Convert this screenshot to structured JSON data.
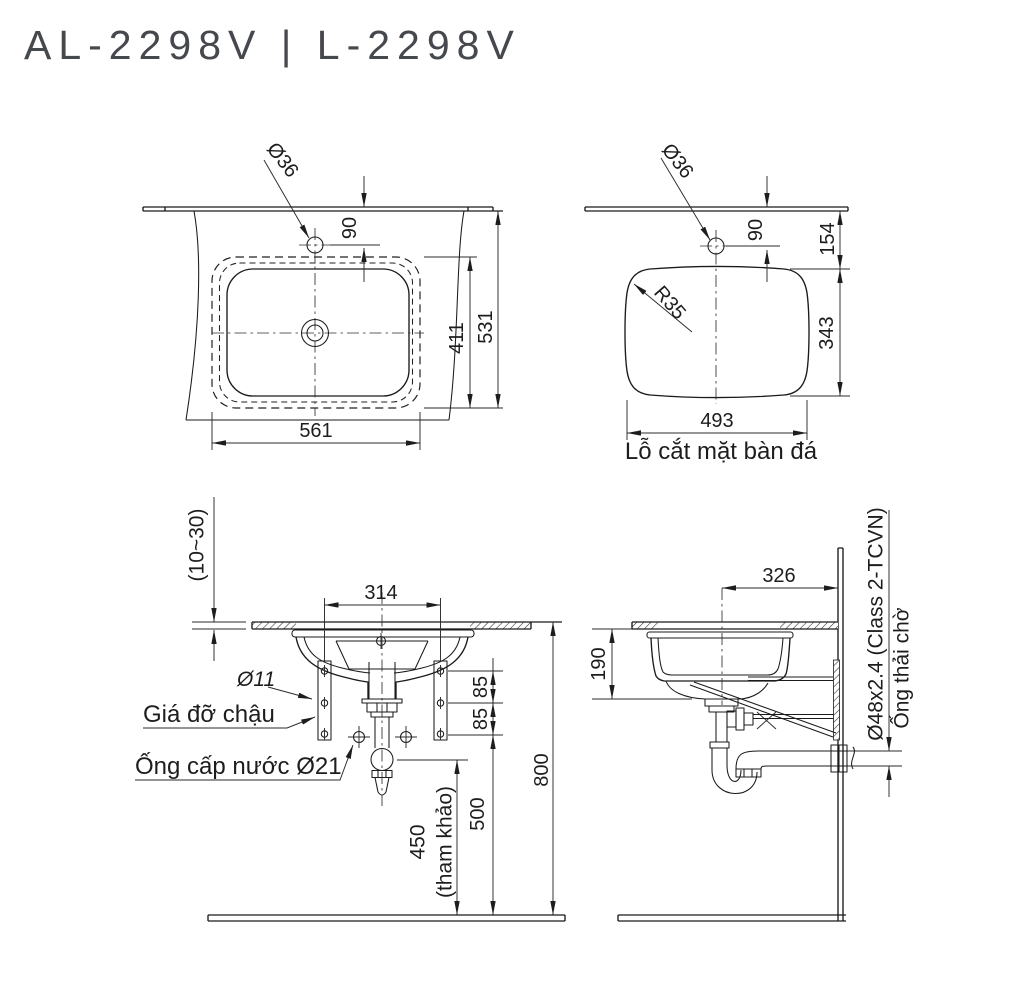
{
  "title": "AL-2298V | L-2298V",
  "plan": {
    "faucet_hole_dia": "Ø36",
    "hole_to_edge": "90",
    "bowl_depth": "411",
    "overall_depth": "531",
    "bowl_width": "561"
  },
  "cutout": {
    "faucet_hole_dia": "Ø36",
    "hole_to_edge": "90",
    "edge_to_cutout": "154",
    "corner_radius": "R35",
    "cutout_depth": "343",
    "cutout_width": "493",
    "caption": "Lỗ cắt mặt bàn đá"
  },
  "front": {
    "counter_thickness": "(10~30)",
    "bracket_spacing": "314",
    "bracket_hole_dia": "Ø11",
    "bracket_label": "Giá đỡ chậu",
    "supply_label": "Ống cấp nước Ø21",
    "hole_gap_1": "85",
    "hole_gap_2": "85",
    "drain_height": "450",
    "drain_height_note": "(tham khảo)",
    "supply_height": "500",
    "counter_height": "800"
  },
  "side": {
    "center_to_wall": "326",
    "bowl_height": "190",
    "waste_pipe_spec": "Ø48x2.4 (Class 2-TCVN)",
    "waste_pipe_label": "Ống thải chờ"
  }
}
